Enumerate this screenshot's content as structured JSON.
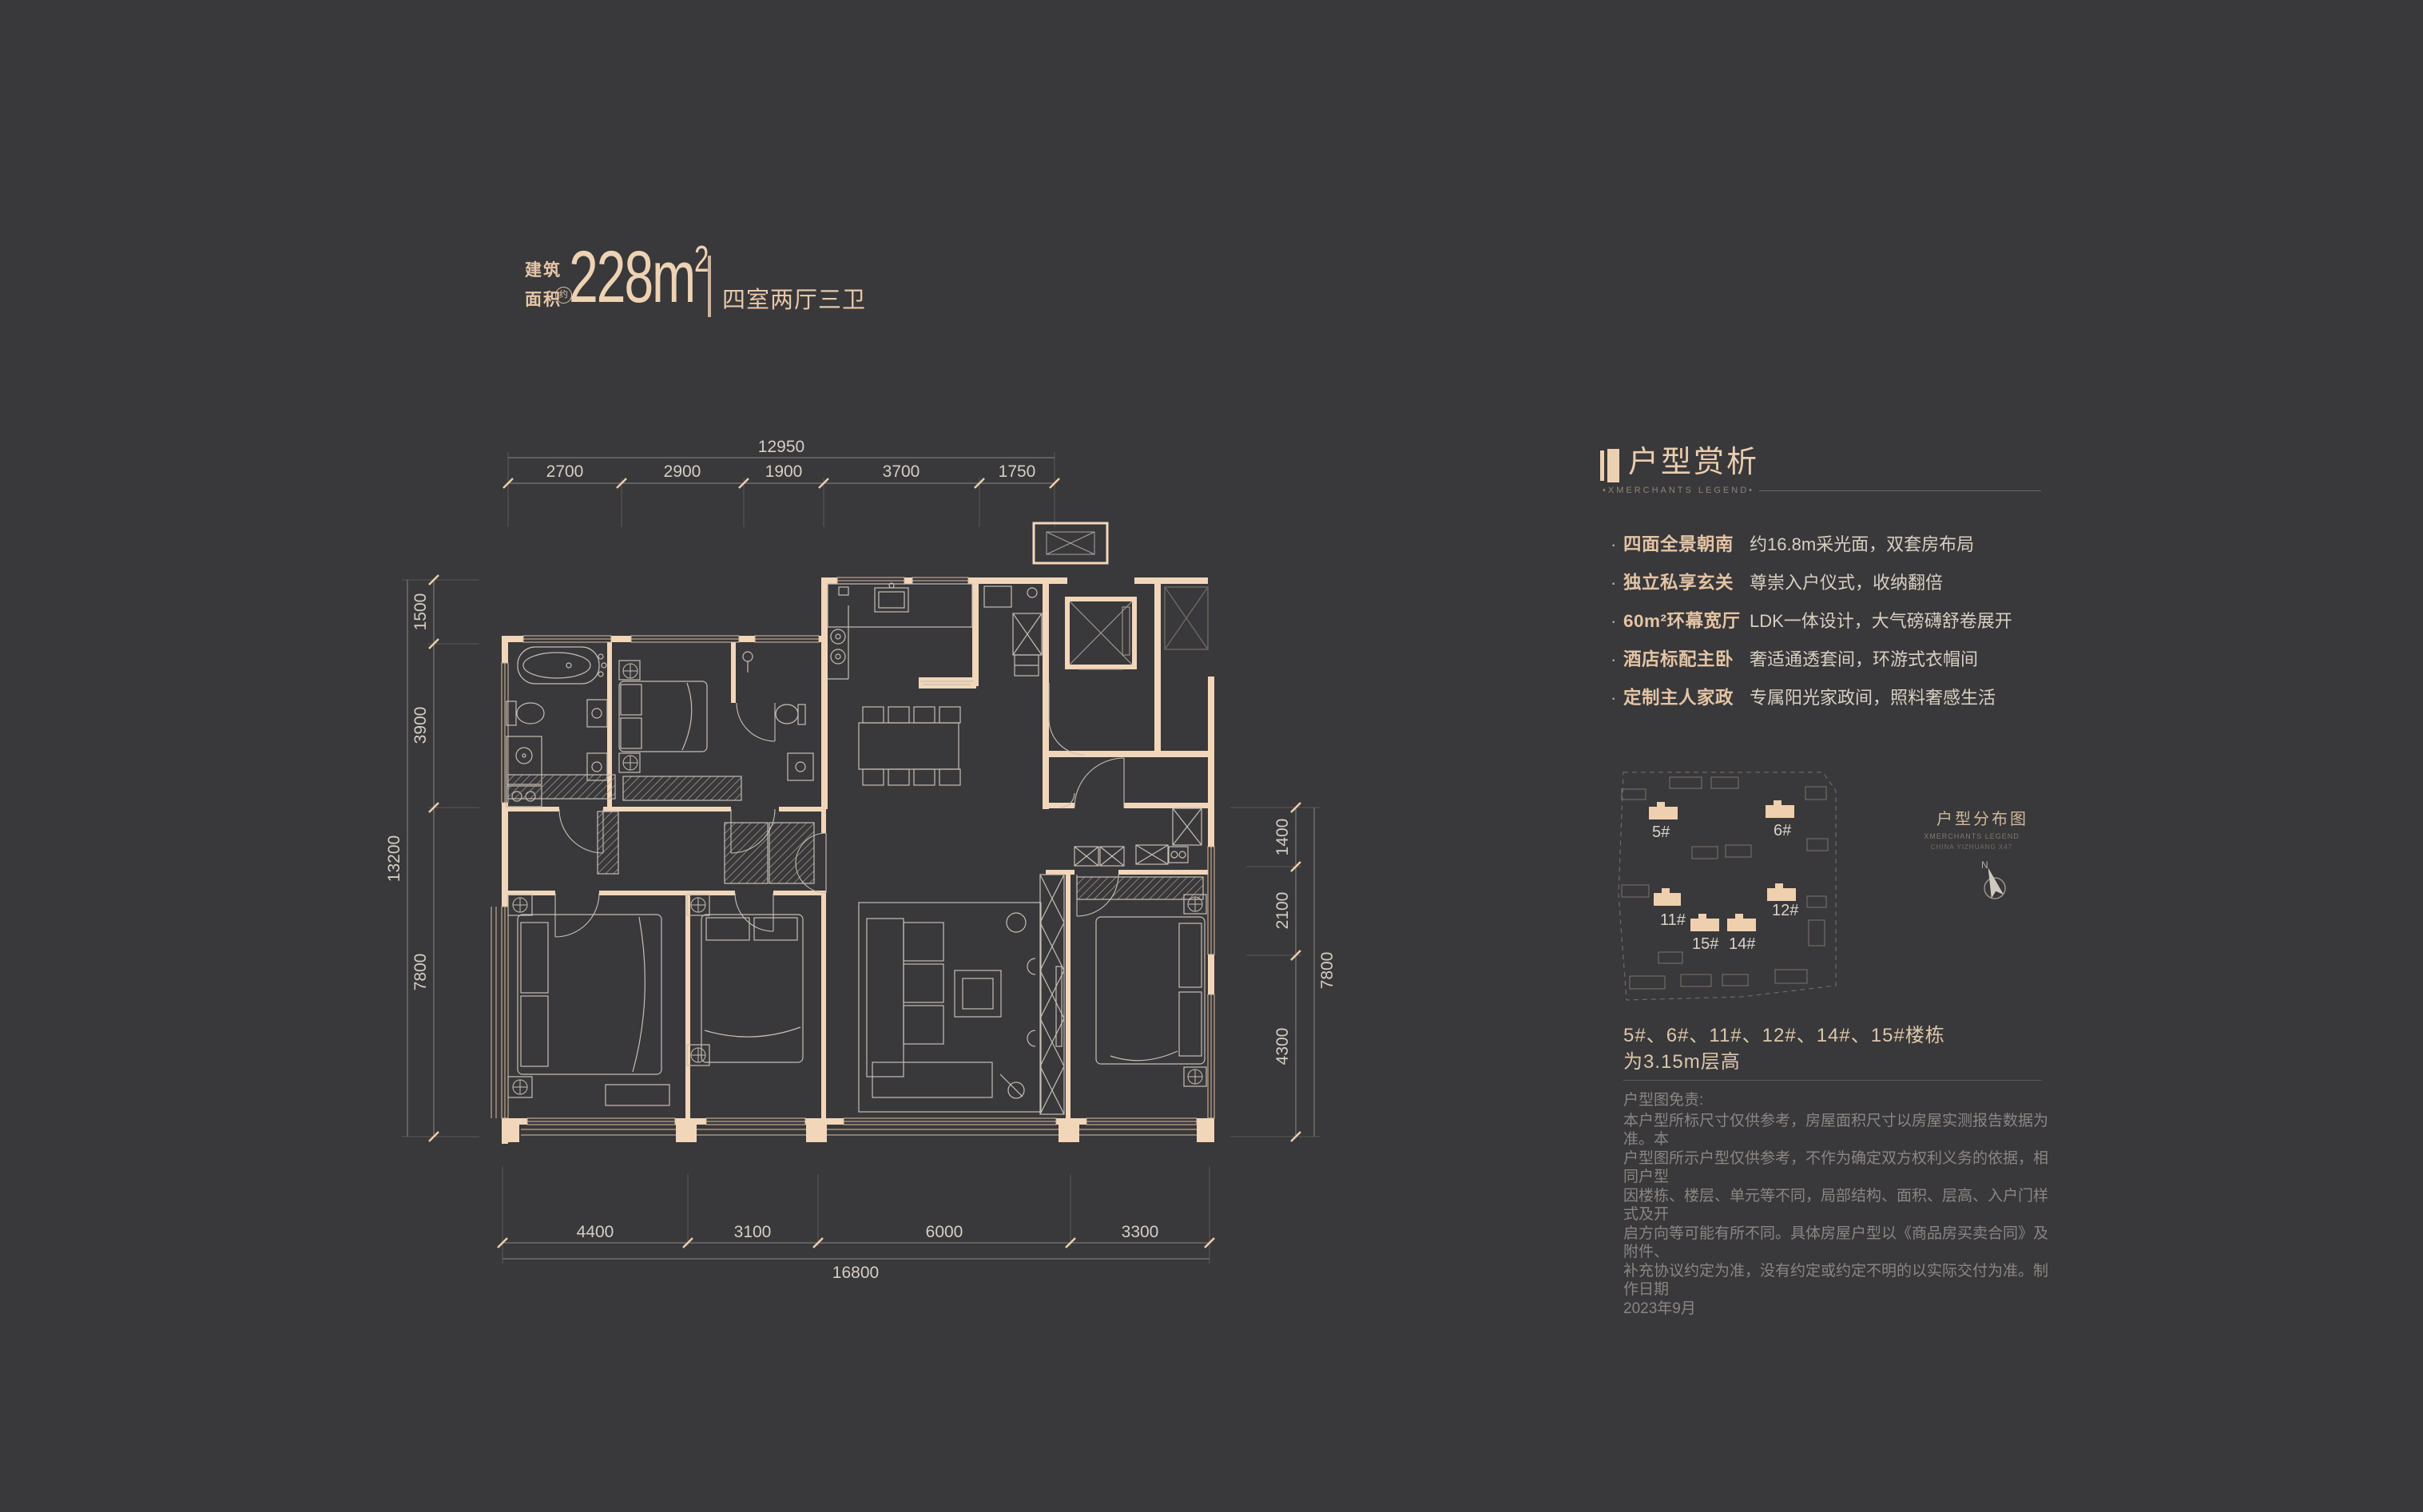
{
  "title": {
    "area_label_line1": "建筑",
    "area_label_line2": "面积",
    "approx_badge": "约",
    "area_value": "228m",
    "area_sup": "2",
    "layout_text": "四室两厅三卫"
  },
  "analysis": {
    "heading": "户型赏析",
    "subheading": "•XMERCHANTS LEGEND•",
    "bullet": "·",
    "items": [
      {
        "label": "四面全景朝南",
        "desc": "约16.8m采光面，双套房布局"
      },
      {
        "label": "独立私享玄关",
        "desc": "尊崇入户仪式，收纳翻倍"
      },
      {
        "label": "60m²环幕宽厅",
        "desc": "LDK一体设计，大气磅礴舒卷展开"
      },
      {
        "label": "酒店标配主卧",
        "desc": "奢适通透套间，环游式衣帽间"
      },
      {
        "label": "定制主人家政",
        "desc": "专属阳光家政间，照料奢感生活"
      }
    ]
  },
  "siteplan": {
    "title": "户型分布图",
    "subtitle1": "XMERCHANTS LEGEND",
    "subtitle2": "CHINA YIZHUANG X47",
    "north_label": "N",
    "buildings": [
      "5#",
      "6#",
      "11#",
      "12#",
      "15#",
      "14#"
    ]
  },
  "note": {
    "line1": "5#、6#、11#、12#、14#、15#楼栋",
    "line2": "为3.15m层高"
  },
  "disclaimer": {
    "title": "户型图免责:",
    "lines": [
      "本户型所标尺寸仅供参考，房屋面积尺寸以房屋实测报告数据为准。本",
      "户型图所示户型仅供参考，不作为确定双方权利义务的依据，相同户型",
      "因楼栋、楼层、单元等不同，局部结构、面积、层高、入户门样式及开",
      "启方向等可能有所不同。具体房屋户型以《商品房买卖合同》及附件、",
      "补充协议约定为准，没有约定或约定不明的以实际交付为准。制作日期",
      "2023年9月"
    ]
  },
  "floorplan": {
    "dims": {
      "top": {
        "total": "12950",
        "segments": [
          "2700",
          "2900",
          "1900",
          "3700",
          "1750"
        ]
      },
      "bottom": {
        "total": "16800",
        "segments": [
          "4400",
          "3100",
          "6000",
          "3300"
        ]
      },
      "left": {
        "total": "13200",
        "segments": [
          "1500",
          "3900",
          "7800"
        ]
      },
      "right": {
        "total": "7800",
        "segments": [
          "1400",
          "2100",
          "4300"
        ]
      }
    }
  },
  "colors": {
    "background": "#39383a",
    "wall": "#f2d6ba",
    "accent": "#e8cba9"
  }
}
